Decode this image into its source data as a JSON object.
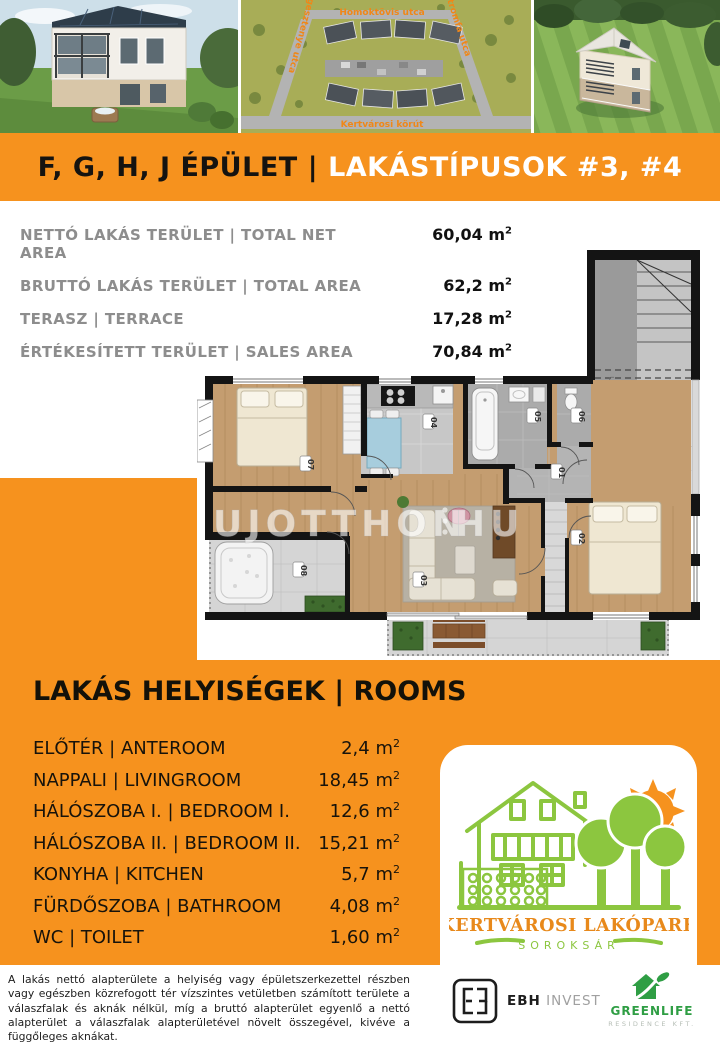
{
  "banner": {
    "left": "F, G, H, J ÉPÜLET",
    "separator": "|",
    "right": "LAKÁSTÍPUSOK #3, #4"
  },
  "site_plan_labels": {
    "top": "Homoktövis utca",
    "bottom": "Kertvárosi körút",
    "left": "Vadgesztenye utca",
    "right": "Citromfa utca"
  },
  "areas": {
    "rows": [
      {
        "label": "NETTÓ LAKÁS TERÜLET | TOTAL NET AREA",
        "value": "60,04"
      },
      {
        "label": "BRUTTÓ LAKÁS TERÜLET | TOTAL AREA",
        "value": "62,2"
      },
      {
        "label": "TERASZ | TERRACE",
        "value": "17,28"
      },
      {
        "label": "ÉRTÉKESÍTETT TERÜLET | SALES AREA",
        "value": "70,84"
      }
    ]
  },
  "unit": {
    "symbol": "m",
    "sup": "2"
  },
  "floorplan": {
    "watermark_left": "UJOTTHON",
    "watermark_right": "HU",
    "stair_label": "lph",
    "badges": {
      "bedroom1": "07",
      "kitchen": "04",
      "bathroom": "05",
      "wc": "06",
      "anteroom": "01",
      "living": "03",
      "bedroom2": "02",
      "terrace": "08"
    }
  },
  "rooms": {
    "title": "LAKÁS HELYISÉGEK | ROOMS",
    "rows": [
      {
        "label": "ELŐTÉR | ANTEROOM",
        "value": "2,4"
      },
      {
        "label": "NAPPALI | LIVINGROOM",
        "value": "18,45"
      },
      {
        "label": "HÁLÓSZOBA I. | BEDROOM I.",
        "value": "12,6"
      },
      {
        "label": "HÁLÓSZOBA II. | BEDROOM II.",
        "value": "15,21"
      },
      {
        "label": "KONYHA | KITCHEN",
        "value": "5,7"
      },
      {
        "label": "FÜRDŐSZOBA | BATHROOM",
        "value": "4,08"
      },
      {
        "label": "WC | TOILET",
        "value": "1,60"
      }
    ]
  },
  "project_logo": {
    "title": "KERTVÁROSI LAKÓPARK",
    "subtitle": "SOROKSÁR"
  },
  "footer": {
    "disclaimer": "A lakás nettó alapterülete a helyiség vagy épületszerkezettel részben vagy egészben közrefogott tér vízszintes vetületben számított területe a válaszfalak és aknák nélkül, míg a bruttó alapterület egyenlő a nettó alapterület a válaszfalak alapterületével növelt összegével, kivéve a függőleges aknákat.",
    "ebh": {
      "name": "EBH",
      "suffix": "INVEST"
    },
    "greenlife": {
      "name": "GREENLIFE",
      "subtitle": "RESIDENCE KFT."
    }
  },
  "colors": {
    "orange": "#F6921E",
    "logo_green": "#8CC63F",
    "logo_orange": "#E8891B",
    "greenlife_green": "#2F9E44"
  }
}
